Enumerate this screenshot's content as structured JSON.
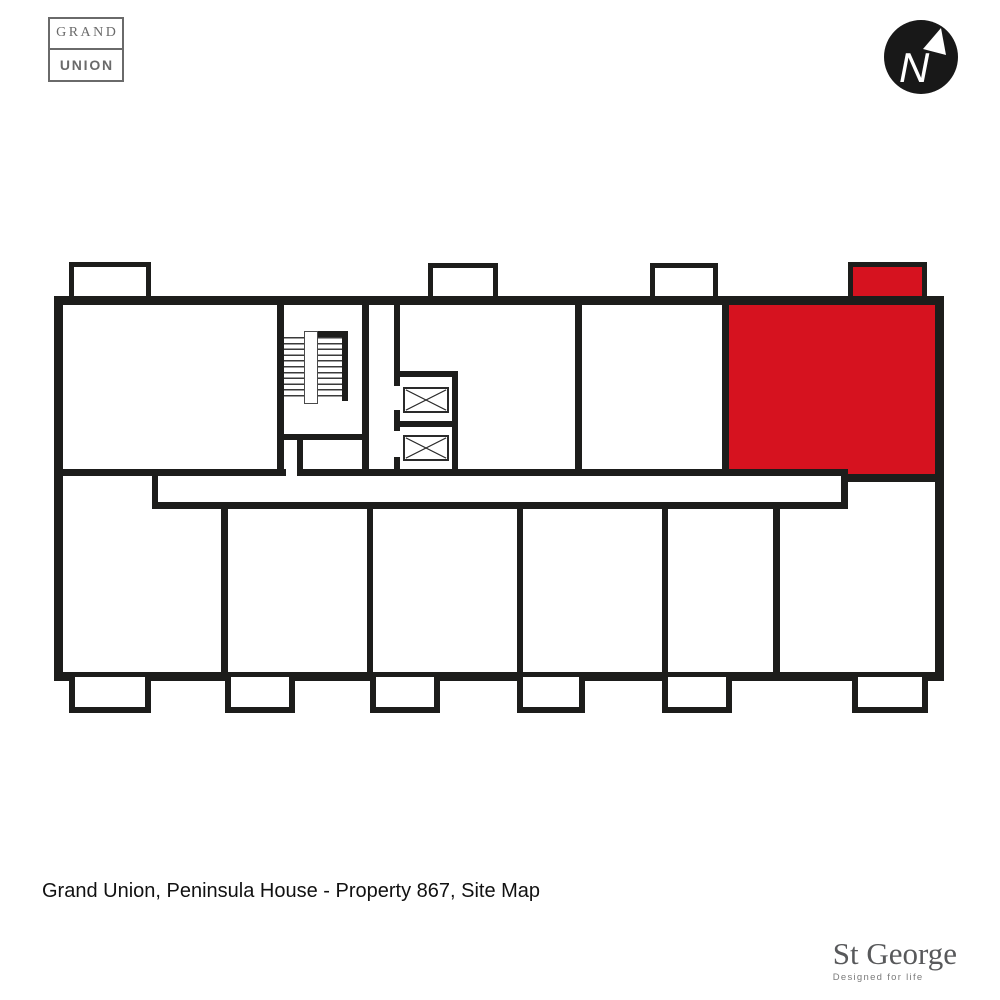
{
  "title_caption": "Grand Union, Peninsula House - Property 867, Site Map",
  "branding": {
    "grand_union": {
      "line1": "GRAND",
      "line2": "UNION"
    },
    "st_george": {
      "name": "St George",
      "tagline": "Designed for life"
    }
  },
  "compass": {
    "letter": "N"
  },
  "colors": {
    "highlight": "#d6121f",
    "wall": "#1d1d1b",
    "logo_gray": "#6a6a6a",
    "st_george_gray": "#58595b",
    "tagline_gray": "#7b7b7b",
    "caption_black": "#111111"
  },
  "floor_plan": {
    "highlighted_unit": "Property 867",
    "stair_cores": 1,
    "lifts": 2,
    "top_balconies": 4,
    "bottom_balconies": 6
  }
}
